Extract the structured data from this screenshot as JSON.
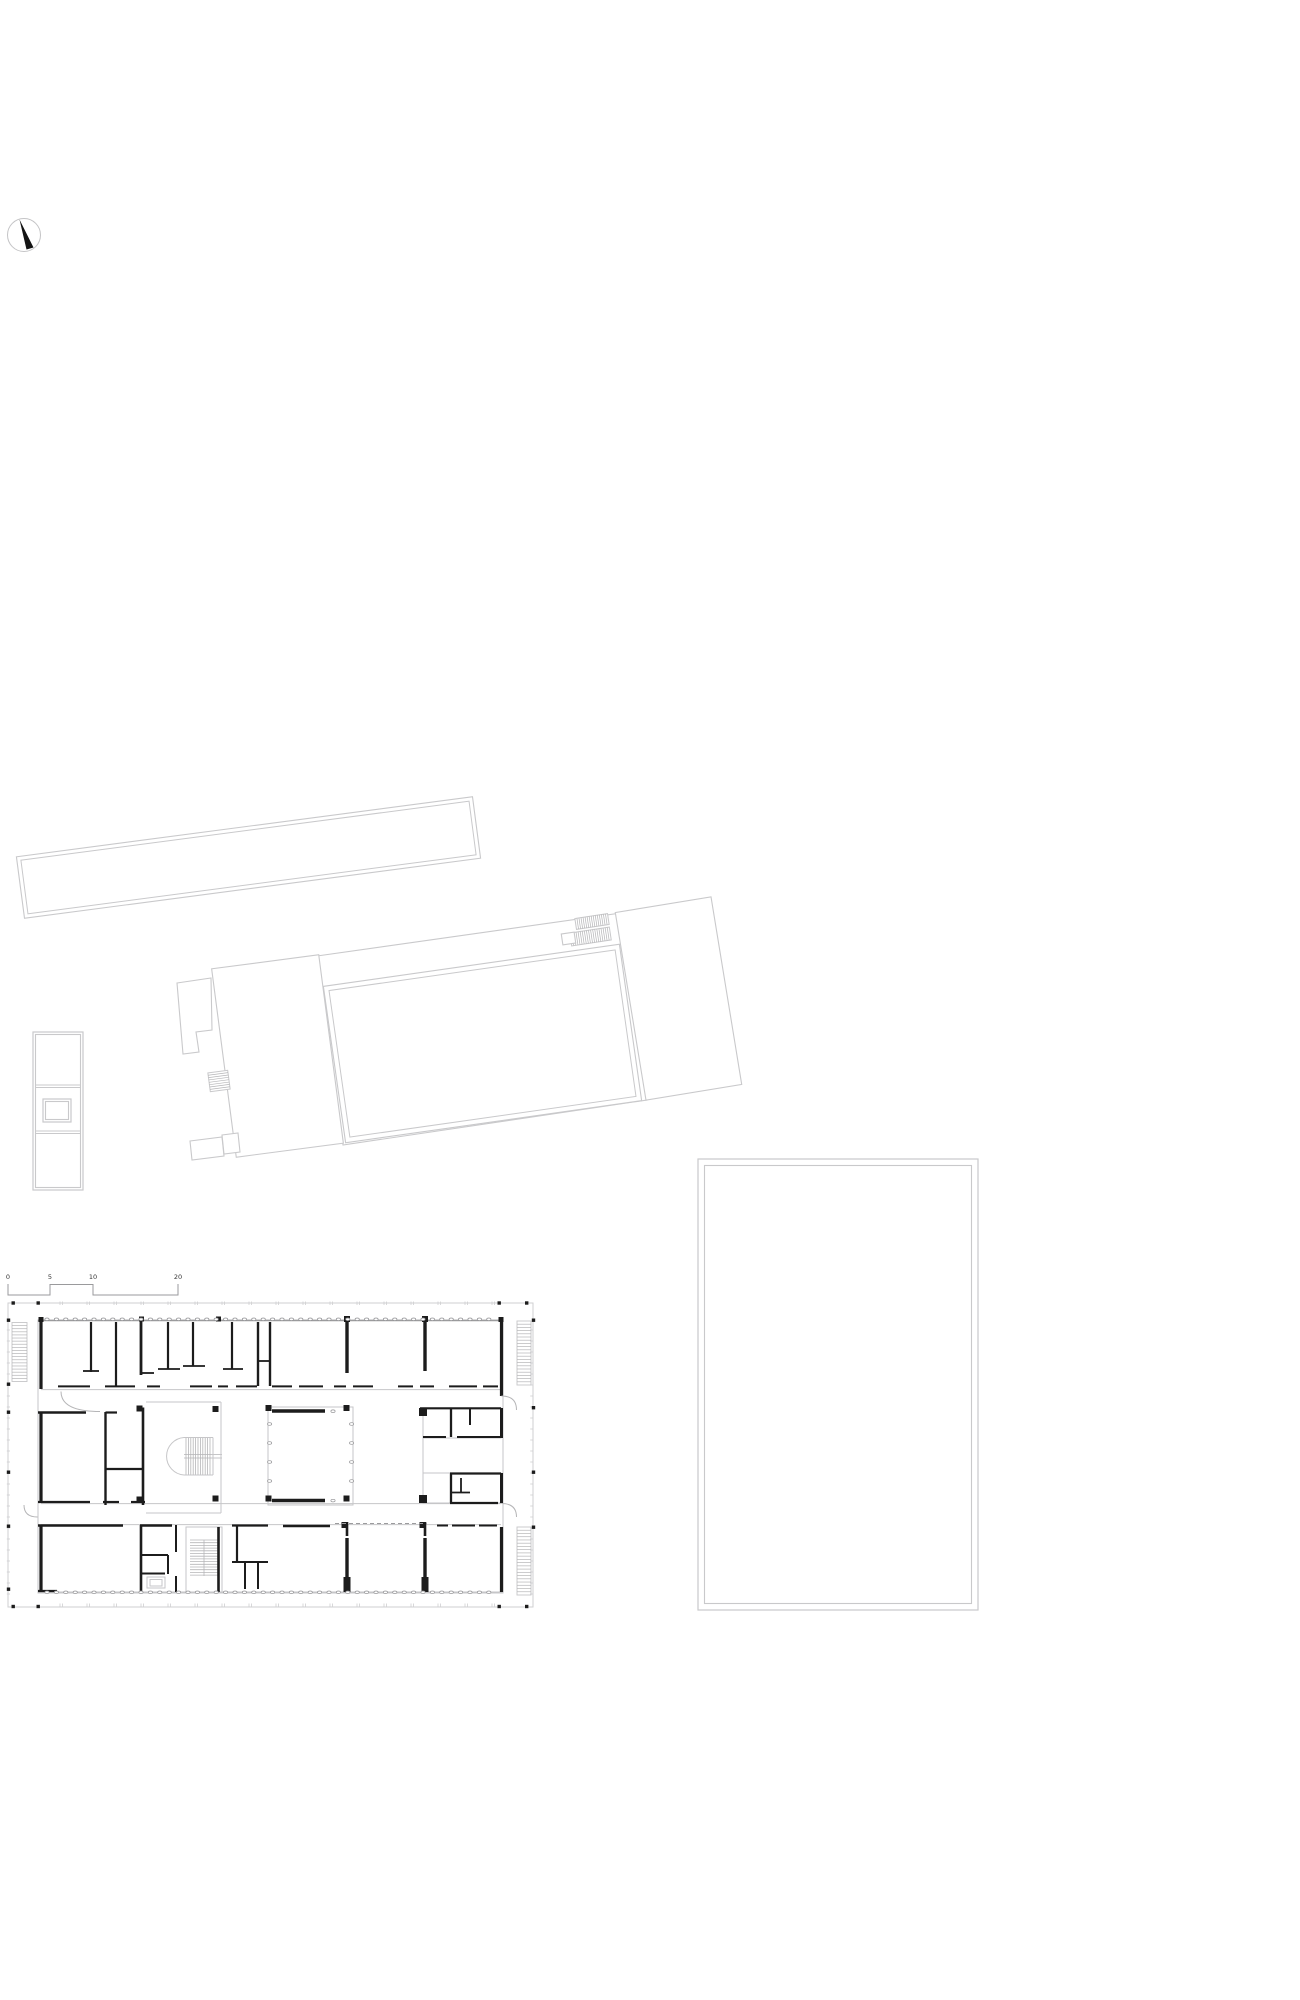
{
  "title": "site-and-floor-plan-drawing",
  "colors": {
    "wall": "#1c1c1c",
    "site_outline": "#c9c9cb",
    "light": "#c6c6c8",
    "medium": "#9b9b9d",
    "hatch": "#b5b5b7",
    "oval": "#919194",
    "label": "#333333",
    "boundary": "#cfcfd1",
    "dash": "#9b9b9d",
    "bg": "#ffffff"
  },
  "compass": {
    "cx": 24,
    "cy": 235,
    "r": 16.5,
    "ring_color": "#c4c4c6",
    "needle_points": "19.5,219.5 33.5,247.5 26.5,249.5",
    "needle_color": "#141414"
  },
  "scale_bar": {
    "path": "M8,1284 L8,1295 L50,1295 L50,1284.5 L93,1284.5 L93,1295 L178,1295 L178,1284",
    "color": "#9a9a9c",
    "font_size": 6.5,
    "label_y": 1279,
    "labels": [
      {
        "text": "0",
        "x": 8
      },
      {
        "text": "5",
        "x": 50
      },
      {
        "text": "10",
        "x": 93
      },
      {
        "text": "20",
        "x": 178
      }
    ]
  },
  "site_buildings": [
    {
      "name": "long-building",
      "type": "rotrect",
      "cx": 248.5,
      "cy": 857.5,
      "w": 460,
      "h": 62,
      "rot": -7.5,
      "inset": 4
    },
    {
      "name": "hall-canopy",
      "type": "polygon",
      "points": [
        [
          317,
          956
        ],
        [
          621,
          913
        ],
        [
          647,
          1100
        ],
        [
          343,
          1145
        ]
      ]
    },
    {
      "name": "hall",
      "type": "rotrect",
      "cx": 482.5,
      "cy": 1043.5,
      "w": 299,
      "h": 158,
      "rot": -8.1,
      "inset": 5
    },
    {
      "name": "west-wing",
      "type": "rotrect",
      "cx": 277.5,
      "cy": 1056,
      "w": 108,
      "h": 190,
      "rot": -7.45
    },
    {
      "name": "west-wing-annex",
      "type": "polygon",
      "points": [
        [
          177,
          983
        ],
        [
          211,
          978
        ],
        [
          212,
          1030
        ],
        [
          196,
          1032
        ],
        [
          199,
          1052
        ],
        [
          183,
          1054
        ]
      ]
    },
    {
      "name": "west-wing-annex-south",
      "type": "polygon",
      "points": [
        [
          190,
          1141
        ],
        [
          222,
          1137
        ],
        [
          224,
          1156
        ],
        [
          192,
          1160
        ]
      ]
    },
    {
      "name": "west-wing-annex-south-2",
      "type": "polygon",
      "points": [
        [
          222,
          1135
        ],
        [
          238,
          1133
        ],
        [
          240,
          1152
        ],
        [
          224,
          1154
        ]
      ]
    },
    {
      "name": "west-wing-exterior-stair",
      "type": "hatchrect",
      "cx": 219,
      "cy": 1081,
      "w": 20,
      "h": 19,
      "rot": -7.5,
      "n": 7,
      "dir": "h"
    },
    {
      "name": "east-building",
      "type": "rotrect",
      "cx": 678.5,
      "cy": 998.5,
      "w": 97,
      "h": 190,
      "rot": -9.3
    },
    {
      "name": "east-building-stair-1",
      "type": "hatchrect",
      "cx": 592,
      "cy": 921.5,
      "w": 33,
      "h": 11,
      "rot": -8.5,
      "n": 15,
      "dir": "v"
    },
    {
      "name": "east-building-stair-2",
      "type": "hatchrect",
      "cx": 590.5,
      "cy": 936.5,
      "w": 40,
      "h": 13,
      "rot": -8.5,
      "n": 18,
      "dir": "v"
    },
    {
      "name": "east-building-landing",
      "type": "rotrect",
      "cx": 568.5,
      "cy": 938.5,
      "w": 13,
      "h": 11,
      "rot": -8.5
    },
    {
      "name": "kiosk-outer",
      "type": "rect",
      "x": 33,
      "y": 1032,
      "w": 50,
      "h": 158,
      "inset": 2.5
    },
    {
      "name": "kiosk-dividers",
      "type": "lines",
      "segs": [
        [
          35.5,
          1085,
          80.5,
          1085
        ],
        [
          35.5,
          1087.5,
          80.5,
          1087.5
        ],
        [
          35.5,
          1131,
          80.5,
          1131
        ],
        [
          35.5,
          1133.5,
          80.5,
          1133.5
        ]
      ]
    },
    {
      "name": "kiosk-inner-cell",
      "type": "rect",
      "x": 43,
      "y": 1099,
      "w": 28,
      "h": 23,
      "inset": 2.5
    },
    {
      "name": "sports-field",
      "type": "rect",
      "x": 698,
      "y": 1159,
      "w": 280,
      "h": 451,
      "inset": 6.5
    }
  ],
  "floor_plan": {
    "boundary": {
      "x": 8,
      "y": 1303,
      "w": 525,
      "h": 304
    },
    "building_outline": {
      "x": 38,
      "y": 1320,
      "w": 465,
      "h": 273
    },
    "medium_lines": [
      [
        38,
        1320.5,
        503,
        1320.5,
        1.4
      ]
    ],
    "light_lines": [
      [
        38,
        1592,
        503,
        1592,
        1
      ],
      [
        41,
        1389.6,
        501,
        1389.6,
        1
      ],
      [
        41,
        1503.6,
        501,
        1503.6,
        1
      ],
      [
        41,
        1524.6,
        501,
        1524.6,
        1
      ],
      [
        146,
        1402,
        221,
        1402,
        1
      ],
      [
        221,
        1402,
        221,
        1513,
        1
      ],
      [
        146,
        1513,
        221,
        1513,
        1
      ],
      [
        184,
        1437.5,
        213,
        1437.5,
        1
      ],
      [
        184,
        1475,
        213,
        1475,
        1
      ],
      [
        213,
        1437.5,
        213,
        1475,
        1
      ],
      [
        184,
        1454.5,
        222,
        1454.5,
        1
      ],
      [
        184,
        1458,
        222,
        1458,
        1
      ],
      [
        204,
        1540,
        204,
        1576,
        1
      ],
      [
        423,
        1438,
        423,
        1473,
        1
      ]
    ],
    "light_rects": [
      {
        "name": "atrium-court",
        "x": 268,
        "y": 1407,
        "w": 85,
        "h": 98
      },
      {
        "name": "wc-cluster-upper",
        "x": 423,
        "y": 1408,
        "w": 78,
        "h": 30
      },
      {
        "name": "wc-cluster-lower",
        "x": 423,
        "y": 1473,
        "w": 78,
        "h": 30
      },
      {
        "name": "south-stair-outline",
        "x": 186,
        "y": 1527,
        "w": 36,
        "h": 66
      },
      {
        "name": "elevator",
        "x": 147,
        "y": 1577,
        "w": 18,
        "h": 11
      },
      {
        "name": "elevator-inner",
        "x": 150,
        "y": 1579.5,
        "w": 12,
        "h": 6.5
      }
    ],
    "walls": [
      [
        41,
        1320,
        41,
        1389,
        3.2
      ],
      [
        91,
        1322,
        91,
        1372,
        2.2
      ],
      [
        83,
        1371,
        99,
        1371,
        1.8
      ],
      [
        116,
        1322,
        116,
        1387,
        2.2
      ],
      [
        141,
        1320,
        141,
        1375,
        2.8
      ],
      [
        141,
        1373,
        154,
        1373,
        1.8
      ],
      [
        168,
        1322,
        168,
        1369,
        2.2
      ],
      [
        158,
        1369,
        180,
        1369,
        1.8
      ],
      [
        193,
        1322,
        193,
        1366,
        2.2
      ],
      [
        183,
        1366,
        205,
        1366,
        1.8
      ],
      [
        232,
        1322,
        232,
        1369,
        2.2
      ],
      [
        223,
        1369,
        243,
        1369,
        1.8
      ],
      [
        258,
        1322,
        258,
        1386,
        2.4
      ],
      [
        270,
        1322,
        270,
        1386,
        2.4
      ],
      [
        258,
        1361,
        270,
        1361,
        1.8
      ],
      [
        347,
        1322,
        347,
        1373,
        3.4
      ],
      [
        425,
        1322,
        425,
        1371,
        3.4
      ],
      [
        501.5,
        1320,
        501.5,
        1396,
        3.2
      ],
      [
        58,
        1386.4,
        90,
        1386.4,
        2
      ],
      [
        105,
        1386.4,
        135,
        1386.4,
        2
      ],
      [
        147,
        1386.4,
        160,
        1386.4,
        2
      ],
      [
        190,
        1386.4,
        212,
        1386.4,
        2
      ],
      [
        218,
        1386.4,
        228,
        1386.4,
        2
      ],
      [
        236,
        1386.4,
        257,
        1386.4,
        2
      ],
      [
        272,
        1386.4,
        292,
        1386.4,
        2
      ],
      [
        299,
        1386.4,
        323,
        1386.4,
        2
      ],
      [
        334,
        1386.4,
        346,
        1386.4,
        2
      ],
      [
        353,
        1386.4,
        373,
        1386.4,
        2
      ],
      [
        398,
        1386.4,
        413,
        1386.4,
        2
      ],
      [
        420,
        1386.4,
        434,
        1386.4,
        2
      ],
      [
        449,
        1386.4,
        477,
        1386.4,
        2
      ],
      [
        483,
        1386.4,
        498,
        1386.4,
        2
      ],
      [
        38,
        1412.5,
        86,
        1412.5,
        2.4
      ],
      [
        105.5,
        1412.5,
        117,
        1412.5,
        2.2
      ],
      [
        105.5,
        1412,
        105.5,
        1505,
        2.4
      ],
      [
        143,
        1407.5,
        143,
        1505,
        2.6
      ],
      [
        105.5,
        1469,
        143,
        1469,
        2.2
      ],
      [
        272,
        1411,
        325,
        1411,
        3.6
      ],
      [
        420,
        1408.3,
        501,
        1408.3,
        2.2
      ],
      [
        451,
        1408,
        451,
        1437,
        2.3
      ],
      [
        470,
        1408,
        470,
        1425,
        2
      ],
      [
        423,
        1437,
        446,
        1437,
        2
      ],
      [
        457,
        1437,
        501,
        1437,
        2.1
      ],
      [
        501.5,
        1408,
        501.5,
        1438,
        3
      ],
      [
        41,
        1412,
        41,
        1502,
        3.2
      ],
      [
        38,
        1502,
        90,
        1502,
        2.3
      ],
      [
        103,
        1502,
        119,
        1502,
        2.2
      ],
      [
        131,
        1502,
        145,
        1502,
        2.2
      ],
      [
        272,
        1500.5,
        325,
        1500.5,
        3.6
      ],
      [
        451,
        1473.5,
        451,
        1503,
        2.3
      ],
      [
        450,
        1473.5,
        501,
        1473.5,
        2.3
      ],
      [
        461,
        1478,
        461,
        1492,
        1.8
      ],
      [
        451,
        1492.5,
        470,
        1492.5,
        1.8
      ],
      [
        450,
        1503,
        498,
        1503,
        2.3
      ],
      [
        501.5,
        1473,
        501.5,
        1503,
        3
      ],
      [
        41,
        1525,
        41,
        1591,
        3.2
      ],
      [
        38,
        1525.5,
        123,
        1525.5,
        2.4
      ],
      [
        140,
        1525.5,
        172,
        1525.5,
        2.4
      ],
      [
        232,
        1525.5,
        268,
        1525.5,
        2.2
      ],
      [
        283,
        1526,
        330,
        1526,
        2.4
      ],
      [
        437,
        1525.5,
        448,
        1525.5,
        2
      ],
      [
        452,
        1525.5,
        475,
        1525.5,
        2
      ],
      [
        479,
        1525.5,
        497,
        1525.5,
        2
      ],
      [
        347,
        1522,
        347,
        1536,
        2.6
      ],
      [
        425,
        1522,
        425,
        1536,
        2.6
      ],
      [
        347,
        1538,
        347,
        1592,
        3.4
      ],
      [
        425,
        1538,
        425,
        1592,
        3.4
      ],
      [
        141,
        1525,
        141,
        1592,
        2.6
      ],
      [
        141,
        1555,
        168,
        1555,
        2
      ],
      [
        168,
        1555,
        168,
        1574,
        2
      ],
      [
        141,
        1573.5,
        165,
        1573.5,
        2
      ],
      [
        176,
        1525,
        176,
        1552,
        2
      ],
      [
        176,
        1576,
        176,
        1592,
        2
      ],
      [
        218.5,
        1527,
        218.5,
        1592,
        2.6
      ],
      [
        237,
        1525,
        237,
        1562,
        2.2
      ],
      [
        232,
        1562,
        268,
        1562,
        2
      ],
      [
        245,
        1562,
        245,
        1589,
        2
      ],
      [
        258,
        1562,
        258,
        1589,
        2
      ],
      [
        501.5,
        1527,
        501.5,
        1592,
        3.2
      ],
      [
        38,
        1591,
        57,
        1591,
        2.3
      ]
    ],
    "black_squares": [
      [
        38.5,
        1317,
        5
      ],
      [
        139,
        1316.5,
        5
      ],
      [
        216,
        1316.5,
        5
      ],
      [
        344,
        1316,
        6
      ],
      [
        422,
        1316,
        6
      ],
      [
        498.5,
        1317,
        5
      ],
      [
        212.5,
        1406,
        6
      ],
      [
        212.5,
        1495.5,
        6
      ],
      [
        265.5,
        1405,
        6
      ],
      [
        343.5,
        1405,
        6
      ],
      [
        265.5,
        1495.5,
        6
      ],
      [
        343.5,
        1495.5,
        6
      ],
      [
        419,
        1408,
        8
      ],
      [
        419,
        1495,
        8
      ],
      [
        341.5,
        1522,
        6
      ],
      [
        419.5,
        1522,
        6
      ],
      [
        136.5,
        1405.5,
        6
      ],
      [
        136.5,
        1496.5,
        6
      ]
    ],
    "black_rects": [
      [
        343.5,
        1577,
        7,
        15
      ],
      [
        421.5,
        1577,
        7,
        15
      ]
    ],
    "boundary_squares": {
      "size": 3.4,
      "top": {
        "y": 1301.3,
        "xs": [
          11.5,
          36.5,
          497.5,
          525
        ]
      },
      "bottom": {
        "y": 1604.8,
        "xs": [
          11.5,
          36.5,
          497.5,
          525
        ]
      },
      "left": {
        "x": 6.8,
        "ys": [
          1318.5,
          1382.5,
          1410.5,
          1470.5,
          1524.5,
          1587.5
        ]
      },
      "right": {
        "x": 531.8,
        "ys": [
          1318.5,
          1406,
          1470.5,
          1525.5
        ]
      }
    },
    "ticks": {
      "top": {
        "y": 1301.5,
        "len": 3.5,
        "x0": 60,
        "x1": 492,
        "step": 27,
        "pair": 2.4
      },
      "bottom": {
        "y": 1603.5,
        "len": 3.5,
        "x0": 60,
        "x1": 492,
        "step": 27,
        "pair": 2.4
      },
      "left": {
        "x": 6.8,
        "len": 3.2,
        "y0": 1330,
        "y1": 1599,
        "step": 11
      },
      "right": {
        "x": 530.2,
        "len": 3.2,
        "y0": 1330,
        "y1": 1599,
        "step": 11
      }
    },
    "column_rows": [
      {
        "y": 1319.3,
        "x0": 47,
        "x1": 497,
        "step": 9.4
      },
      {
        "y": 1592.3,
        "x0": 47,
        "x1": 497,
        "step": 9.4
      }
    ],
    "column_cols": [
      {
        "x": 269.6,
        "ys": [
          1424,
          1443,
          1462,
          1481
        ]
      },
      {
        "x": 351.6,
        "ys": [
          1424,
          1443,
          1462,
          1481
        ]
      }
    ],
    "column_single": [
      [
        333,
        1411.2
      ],
      [
        333,
        1500.6
      ]
    ],
    "ext_stairs": [
      {
        "name": "west-facade-stair",
        "x": 12,
        "y": 1322.5,
        "w": 15,
        "h": 59,
        "n": 18
      },
      {
        "name": "east-facade-stair-north",
        "x": 517,
        "y": 1321,
        "w": 14,
        "h": 64,
        "n": 19
      },
      {
        "name": "east-facade-stair-south",
        "x": 517,
        "y": 1527,
        "w": 14,
        "h": 68,
        "n": 20
      }
    ],
    "mid_stair": {
      "arc": "M 184 1437.5 A 18.8 18.8 0 0 0 184 1475",
      "treads": {
        "x0": 186,
        "x1": 211.6,
        "step": 2.4,
        "y0": 1438,
        "y1": 1474.5
      }
    },
    "south_stair_treads": {
      "y0": 1540,
      "y1": 1575.2,
      "step": 2.7,
      "x0": 190,
      "x1": 218
    },
    "door_arcs": [
      "M 61 1391.5 Q 61 1411.5 100 1411.5",
      "M 24 1505 Q 24 1517 37.5 1517",
      "M 501.5 1396 Q 516.5 1396 516.5 1410",
      "M 501.5 1503.5 Q 516.5 1503.5 516.5 1517"
    ],
    "dashed_lines": [
      [
        335,
        1523.5,
        427,
        1523.5
      ]
    ]
  }
}
